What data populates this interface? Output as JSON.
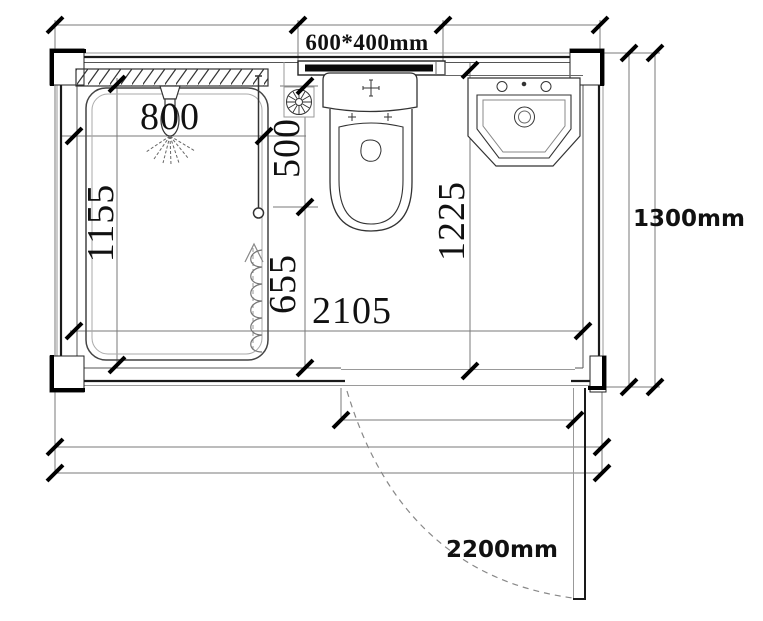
{
  "drawing": {
    "type": "floor-plan",
    "subject": "shower room sanitary unit plan view",
    "labels": {
      "window": "600*400mm",
      "shower_offset": "800",
      "left_interior": "1155",
      "shower_upper": "500",
      "shower_lower": "655",
      "interior_width": "2105",
      "right_interior": "1225",
      "overall_depth": "1300mm",
      "overall_width": "2200mm"
    },
    "colors": {
      "background": "#ffffff",
      "wall_line": "#1a1a1a",
      "aux_line": "#777777",
      "text": "#111111"
    }
  }
}
